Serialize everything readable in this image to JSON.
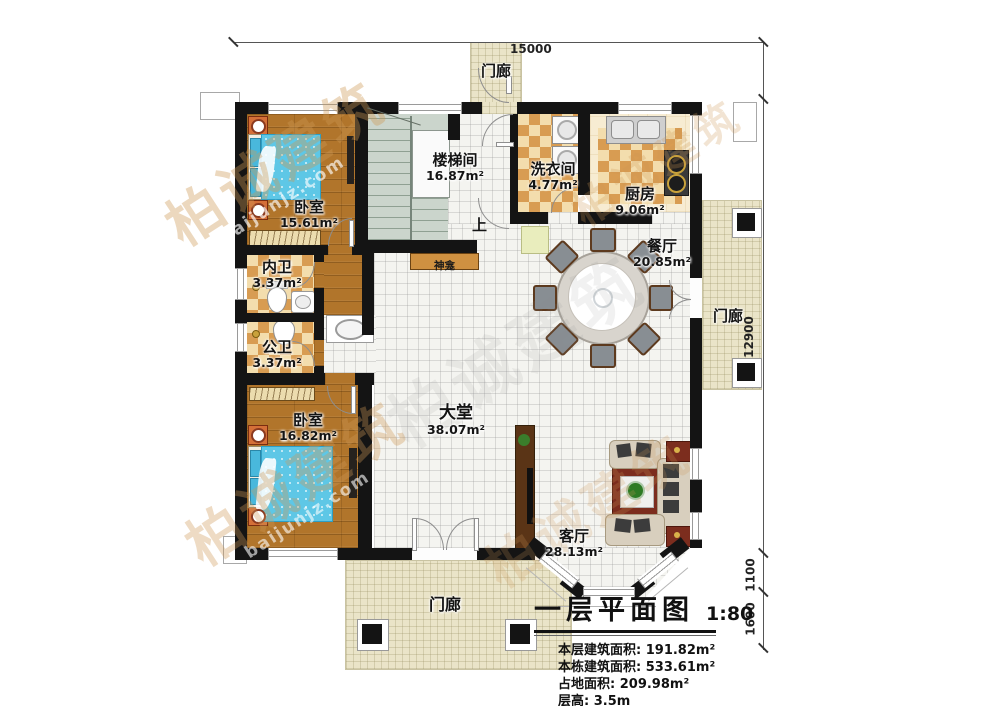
{
  "watermark": {
    "brand": "柏诚建筑",
    "site": "baijunjz.com"
  },
  "dimensions": {
    "top": "15000",
    "right_main": "12900",
    "right_mid": "1100",
    "right_low": "1600"
  },
  "rooms": [
    {
      "id": "porch-top",
      "name": "门廊",
      "area": ""
    },
    {
      "id": "stairwell",
      "name": "楼梯间",
      "area": "16.87m²"
    },
    {
      "id": "laundry",
      "name": "洗衣间",
      "area": "4.77m²"
    },
    {
      "id": "kitchen",
      "name": "厨房",
      "area": "9.06m²"
    },
    {
      "id": "bedroom-1",
      "name": "卧室",
      "area": "15.61m²"
    },
    {
      "id": "bath-inner",
      "name": "内卫",
      "area": "3.37m²"
    },
    {
      "id": "bath-public",
      "name": "公卫",
      "area": "3.37m²"
    },
    {
      "id": "bedroom-2",
      "name": "卧室",
      "area": "16.82m²"
    },
    {
      "id": "hall",
      "name": "大堂",
      "area": "38.07m²"
    },
    {
      "id": "dining",
      "name": "餐厅",
      "area": "20.85m²"
    },
    {
      "id": "living",
      "name": "客厅",
      "area": "28.13m²"
    },
    {
      "id": "porch-right",
      "name": "门廊",
      "area": ""
    },
    {
      "id": "porch-bottom",
      "name": "门廊",
      "area": ""
    }
  ],
  "labels": {
    "up": "上",
    "shrine": "神龛"
  },
  "title_block": {
    "title": "一层平面图",
    "scale": "1:80",
    "stats": [
      {
        "label": "本层建筑面积: ",
        "value": "191.82m²"
      },
      {
        "label": "本栋建筑面积: ",
        "value": "533.61m²"
      },
      {
        "label": "占地面积: ",
        "value": "209.98m²"
      },
      {
        "label": "层高: ",
        "value": "3.5m"
      }
    ]
  }
}
